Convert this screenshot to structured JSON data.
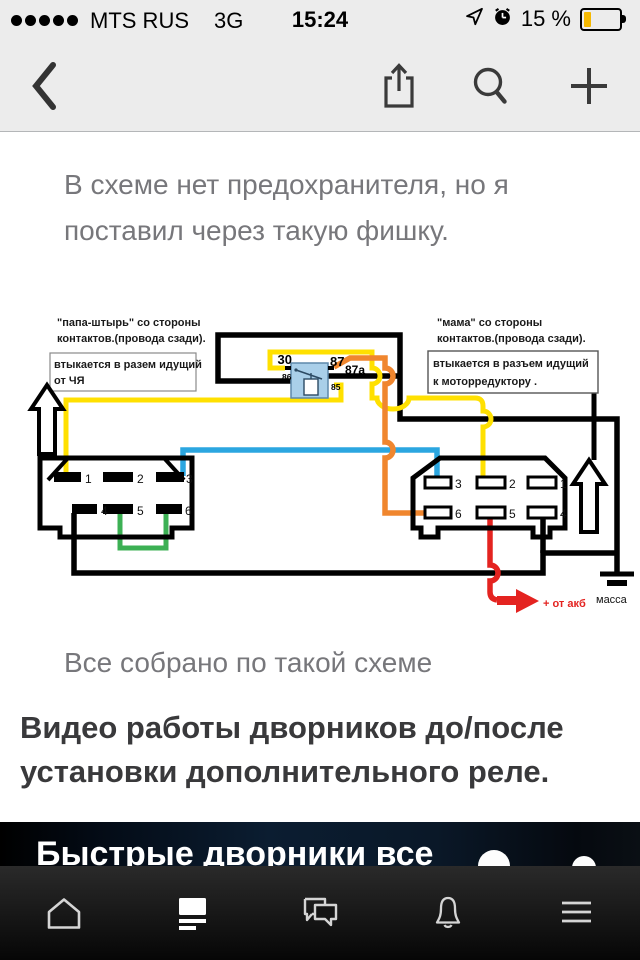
{
  "status_bar": {
    "carrier": "MTS RUS",
    "network": "3G",
    "time": "15:24",
    "battery_percent": "15 %",
    "signal_dots": 5,
    "battery_fill_color": "#f5b800",
    "icons": [
      "signal-dots",
      "location-arrow-icon",
      "alarm-clock-icon",
      "battery-icon"
    ]
  },
  "nav_bar": {
    "icons": [
      "back-chevron",
      "share",
      "search",
      "add"
    ]
  },
  "content": {
    "paragraph": "В схеме нет предохранителя, но я поставил через такую фишку.",
    "caption": "Все собрано по такой схеме",
    "heading": "Видео работы дворников до/после установки дополнительного реле.",
    "video_title_partial": "Быстрые дворники все"
  },
  "diagram": {
    "left_note_line1": "\"папа-штырь\" со стороны",
    "left_note_line2": "контактов.(провода сзади).",
    "left_box_line1": "втыкается в разем идущий",
    "left_box_line2": "от ЧЯ",
    "right_note_line1": "\"мама\" со стороны",
    "right_note_line2": "контактов.(провода сзади).",
    "right_box_line1": "втыкается в разъем идущий",
    "right_box_line2": "к моторредуктору .",
    "relay_pins": {
      "p30": "30",
      "p87": "87",
      "p87a": "87a",
      "p86": "86",
      "p85": "85"
    },
    "left_pins": [
      "1",
      "2",
      "3",
      "4",
      "5",
      "6"
    ],
    "right_pins_top": [
      "3",
      "2",
      "1"
    ],
    "right_pins_bottom": [
      "6",
      "5",
      "4"
    ],
    "battery_label": "+ от акб",
    "ground_label": "масса",
    "wire_colors": {
      "yellow": "#ffe000",
      "orange": "#f0862e",
      "blue": "#2ba6e0",
      "green": "#3cb054",
      "red": "#e42320",
      "black": "#000000",
      "relay_fill": "#a9cfe9",
      "relay_stroke": "#5d88ab"
    }
  },
  "tab_bar": {
    "items": [
      "home",
      "feed",
      "comments",
      "notifications",
      "menu"
    ],
    "active_item": "feed"
  }
}
